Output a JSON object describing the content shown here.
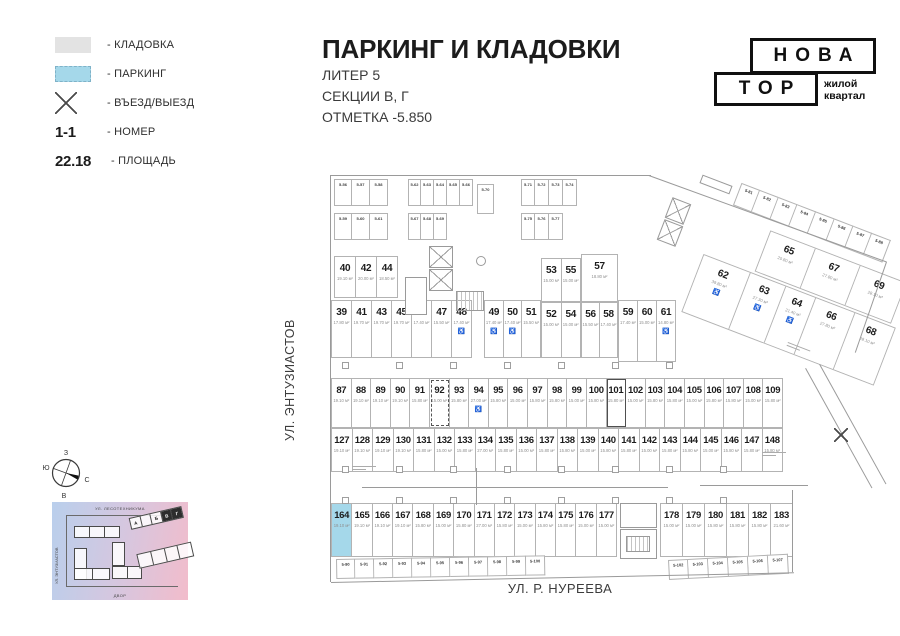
{
  "legend": {
    "items": [
      {
        "label": "- КЛАДОВКА"
      },
      {
        "label": "- ПАРКИНГ"
      },
      {
        "label": "- ВЪЕЗД/ВЫЕЗД"
      },
      {
        "symbol": "1-1",
        "label": "- НОМЕР"
      },
      {
        "symbol": "22.18",
        "label": "- ПЛОЩАДЬ"
      }
    ]
  },
  "title": {
    "main": "ПАРКИНГ И КЛАДОВКИ",
    "line1": "ЛИТЕР 5",
    "line2": "СЕКЦИИ В, Г",
    "line3": "ОТМЕТКА -5.850"
  },
  "logo": {
    "top": "НОВА",
    "bottom": "ТОР",
    "tag1": "жилой",
    "tag2": "квартал"
  },
  "streets": {
    "left": "УЛ. ЭНТУЗИАСТОВ",
    "bottom": "УЛ. Р. НУРЕЕВА"
  },
  "compass": {
    "top": "З",
    "left": "Ю",
    "right": "С",
    "bottom": "В"
  },
  "minimap": {
    "street_top": "УЛ. ЛЕСОТЕХНИКУМА",
    "street_left": "УЛ. ЭНТУЗИАСТОВ",
    "street_bottom": "ДВОР",
    "labels": [
      "А",
      "Б",
      "В",
      "Г"
    ]
  },
  "colors": {
    "parking_highlight": "#a5d8ea",
    "storage_swatch": "#e3e3e3",
    "plan_line": "#b3b3b3"
  },
  "plan": {
    "groups": [
      {
        "id": "gA",
        "x": 334,
        "y": 256,
        "w": 64,
        "h": 42,
        "cells": [
          {
            "n": "40",
            "a": "19.10 м²"
          },
          {
            "n": "42",
            "a": "20.00 м²"
          },
          {
            "n": "44",
            "a": "18.50 м²"
          }
        ]
      },
      {
        "id": "gB",
        "x": 331,
        "y": 300,
        "w": 141,
        "h": 58,
        "cells": [
          {
            "n": "39",
            "a": "17.80 м²"
          },
          {
            "n": "41",
            "a": "19.70 м²"
          },
          {
            "n": "43",
            "a": "19.70 м²"
          },
          {
            "n": "45",
            "a": "19.70 м²"
          },
          {
            "n": "46",
            "a": "17.40 м²"
          },
          {
            "n": "47",
            "a": "15.50 м²"
          },
          {
            "n": "48",
            "a": "17.40 м²",
            "acc": true
          }
        ]
      },
      {
        "id": "gB2",
        "x": 484,
        "y": 300,
        "w": 57,
        "h": 58,
        "cells": [
          {
            "n": "49",
            "a": "17.40 м²",
            "acc": true
          },
          {
            "n": "50",
            "a": "17.40 м²",
            "acc": true
          },
          {
            "n": "51",
            "a": "15.50 м²"
          }
        ]
      },
      {
        "id": "gA2",
        "x": 541,
        "y": 258,
        "w": 40,
        "h": 44,
        "cells": [
          {
            "n": "53",
            "a": "15.00 м²"
          },
          {
            "n": "55",
            "a": "15.00 м²"
          }
        ]
      },
      {
        "id": "gB3",
        "x": 541,
        "y": 302,
        "w": 40,
        "h": 56,
        "cells": [
          {
            "n": "52",
            "a": "15.00 м²"
          },
          {
            "n": "54",
            "a": "15.00 м²"
          }
        ]
      },
      {
        "id": "gA3",
        "x": 581,
        "y": 254,
        "w": 37,
        "h": 48,
        "cells": [
          {
            "n": "57",
            "a": "18.80 м²"
          }
        ]
      },
      {
        "id": "gB4",
        "x": 581,
        "y": 302,
        "w": 37,
        "h": 56,
        "cells": [
          {
            "n": "56",
            "a": "15.50 м²"
          },
          {
            "n": "58",
            "a": "17.40 м²"
          }
        ]
      },
      {
        "id": "gB5",
        "x": 618,
        "y": 300,
        "w": 58,
        "h": 62,
        "cells": [
          {
            "n": "59",
            "a": "17.40 м²"
          },
          {
            "n": "60",
            "a": "15.00 м²"
          },
          {
            "n": "61",
            "a": "14.80 м²",
            "acc": true
          }
        ]
      },
      {
        "id": "gC",
        "x": 331,
        "y": 378,
        "w": 452,
        "h": 50,
        "dense": true,
        "cells": [
          {
            "n": "87",
            "a": "19.10 м²"
          },
          {
            "n": "88",
            "a": "19.10 м²"
          },
          {
            "n": "89",
            "a": "19.10 м²"
          },
          {
            "n": "90",
            "a": "19.10 м²"
          },
          {
            "n": "91",
            "a": "15.80 м²"
          },
          {
            "n": "92",
            "a": "15.00 м²",
            "dashed": true
          },
          {
            "n": "93",
            "a": "15.80 м²"
          },
          {
            "n": "94",
            "a": "27.00 м²",
            "acc": true
          },
          {
            "n": "95",
            "a": "15.80 м²"
          },
          {
            "n": "96",
            "a": "15.00 м²"
          },
          {
            "n": "97",
            "a": "15.80 м²"
          },
          {
            "n": "98",
            "a": "15.80 м²"
          },
          {
            "n": "99",
            "a": "15.00 м²"
          },
          {
            "n": "100",
            "a": "15.80 м²"
          },
          {
            "n": "101",
            "a": "15.80 м²",
            "boxed": true
          },
          {
            "n": "102",
            "a": "15.00 м²"
          },
          {
            "n": "103",
            "a": "15.80 м²"
          },
          {
            "n": "104",
            "a": "15.80 м²"
          },
          {
            "n": "105",
            "a": "15.00 м²"
          },
          {
            "n": "106",
            "a": "15.80 м²"
          },
          {
            "n": "107",
            "a": "15.80 м²"
          },
          {
            "n": "108",
            "a": "15.00 м²"
          },
          {
            "n": "109",
            "a": "15.80 м²"
          }
        ]
      },
      {
        "id": "gD",
        "x": 331,
        "y": 428,
        "w": 452,
        "h": 44,
        "dense": true,
        "cells": [
          {
            "n": "127",
            "a": "19.10 м²"
          },
          {
            "n": "128",
            "a": "19.10 м²"
          },
          {
            "n": "129",
            "a": "19.10 м²"
          },
          {
            "n": "130",
            "a": "19.10 м²"
          },
          {
            "n": "131",
            "a": "15.80 м²"
          },
          {
            "n": "132",
            "a": "15.00 м²"
          },
          {
            "n": "133",
            "a": "15.80 м²"
          },
          {
            "n": "134",
            "a": "27.00 м²"
          },
          {
            "n": "135",
            "a": "15.80 м²"
          },
          {
            "n": "136",
            "a": "15.00 м²"
          },
          {
            "n": "137",
            "a": "15.80 м²"
          },
          {
            "n": "138",
            "a": "15.80 м²"
          },
          {
            "n": "139",
            "a": "15.00 м²"
          },
          {
            "n": "140",
            "a": "15.80 м²"
          },
          {
            "n": "141",
            "a": "15.80 м²"
          },
          {
            "n": "142",
            "a": "15.00 м²"
          },
          {
            "n": "143",
            "a": "15.80 м²"
          },
          {
            "n": "144",
            "a": "15.80 м²"
          },
          {
            "n": "145",
            "a": "15.00 м²"
          },
          {
            "n": "146",
            "a": "15.80 м²"
          },
          {
            "n": "147",
            "a": "15.80 м²"
          },
          {
            "n": "148",
            "a": "15.80 м²"
          }
        ]
      },
      {
        "id": "gE",
        "x": 331,
        "y": 503,
        "w": 286,
        "h": 54,
        "dense": true,
        "cells": [
          {
            "n": "164",
            "a": "19.10 м²",
            "blue": true
          },
          {
            "n": "165",
            "a": "19.10 м²"
          },
          {
            "n": "166",
            "a": "19.10 м²"
          },
          {
            "n": "167",
            "a": "19.10 м²"
          },
          {
            "n": "168",
            "a": "15.80 м²"
          },
          {
            "n": "169",
            "a": "15.00 м²"
          },
          {
            "n": "170",
            "a": "15.80 м²"
          },
          {
            "n": "171",
            "a": "27.00 м²"
          },
          {
            "n": "172",
            "a": "15.80 м²"
          },
          {
            "n": "173",
            "a": "15.00 м²"
          },
          {
            "n": "174",
            "a": "15.80 м²"
          },
          {
            "n": "175",
            "a": "15.80 м²"
          },
          {
            "n": "176",
            "a": "15.00 м²"
          },
          {
            "n": "177",
            "a": "15.00 м²"
          }
        ]
      },
      {
        "id": "gE2",
        "x": 660,
        "y": 503,
        "w": 133,
        "h": 54,
        "dense": true,
        "cells": [
          {
            "n": "178",
            "a": "15.00 м²"
          },
          {
            "n": "179",
            "a": "15.00 м²"
          },
          {
            "n": "180",
            "a": "15.80 м²"
          },
          {
            "n": "181",
            "a": "15.80 м²"
          },
          {
            "n": "182",
            "a": "15.80 м²"
          },
          {
            "n": "183",
            "a": "21.60 м²"
          }
        ]
      }
    ],
    "wing": {
      "x": 720,
      "y": 211,
      "angle": 21,
      "storage": {
        "x": 10,
        "y": -34,
        "cw": 20,
        "ch": 24,
        "cells": [
          "5-81",
          "5-82",
          "5-83",
          "5-84",
          "5-85",
          "5-86",
          "5-87",
          "5-88"
        ]
      },
      "rows": [
        {
          "x": 54,
          "y": 0,
          "h": 44,
          "cw": 48,
          "cells": [
            {
              "n": "65",
              "a": "20.80 м²"
            },
            {
              "n": "67",
              "a": "27.80 м²"
            },
            {
              "n": "69",
              "a": "28.10 м²"
            }
          ]
        },
        {
          "x": 0,
          "y": 46,
          "h": 62,
          "cw": 40,
          "cells": [
            {
              "n": "62",
              "a": "39.80 м²",
              "acc": true,
              "w": 50
            },
            {
              "n": "63",
              "a": "27.30 м²",
              "acc": true,
              "w": 38
            },
            {
              "n": "64",
              "a": "21.40 м²",
              "acc": true,
              "w": 32
            },
            {
              "n": "66",
              "a": "27.80 м²",
              "w": 42
            },
            {
              "n": "68",
              "a": "28.10 м²",
              "w": 42
            }
          ]
        }
      ]
    },
    "storage_top": [
      {
        "x": 334,
        "y": 179,
        "cw": 18,
        "ch": 27,
        "gap": 7,
        "rows": [
          [
            "5-56",
            "5-57",
            "5-58"
          ],
          [
            "5-59",
            "5-60",
            "5-61"
          ]
        ]
      },
      {
        "x": 408,
        "y": 179,
        "cw": 13,
        "ch": 27,
        "gap": 7,
        "rows": [
          [
            "5-62",
            "5-63",
            "5-64",
            "5-65",
            "5-66"
          ],
          [
            "5-67",
            "5-68",
            "5-69"
          ]
        ]
      },
      {
        "x": 477,
        "y": 184,
        "cw": 17,
        "ch": 30,
        "gap": 0,
        "rows": [
          [
            "5-70"
          ]
        ]
      },
      {
        "x": 521,
        "y": 179,
        "cw": 14,
        "ch": 27,
        "gap": 7,
        "rows": [
          [
            "5-71",
            "5-72",
            "5-73",
            "5-74"
          ],
          [
            "5-75",
            "5-76",
            "5-77"
          ]
        ]
      }
    ],
    "storage_bottom": {
      "left": {
        "x": 336,
        "y": 559,
        "angle": -1,
        "cw": 19,
        "ch": 20,
        "cells": [
          "5-90",
          "5-91",
          "5-92",
          "5-93",
          "5-94",
          "5-95",
          "5-96",
          "5-97",
          "5-98",
          "5-99",
          "5-100"
        ]
      },
      "right": {
        "x": 668,
        "y": 560,
        "angle": -3,
        "cw": 20,
        "ch": 20,
        "cells": [
          "5-102",
          "5-103",
          "5-104",
          "5-105",
          "5-106",
          "5-107"
        ]
      }
    }
  }
}
